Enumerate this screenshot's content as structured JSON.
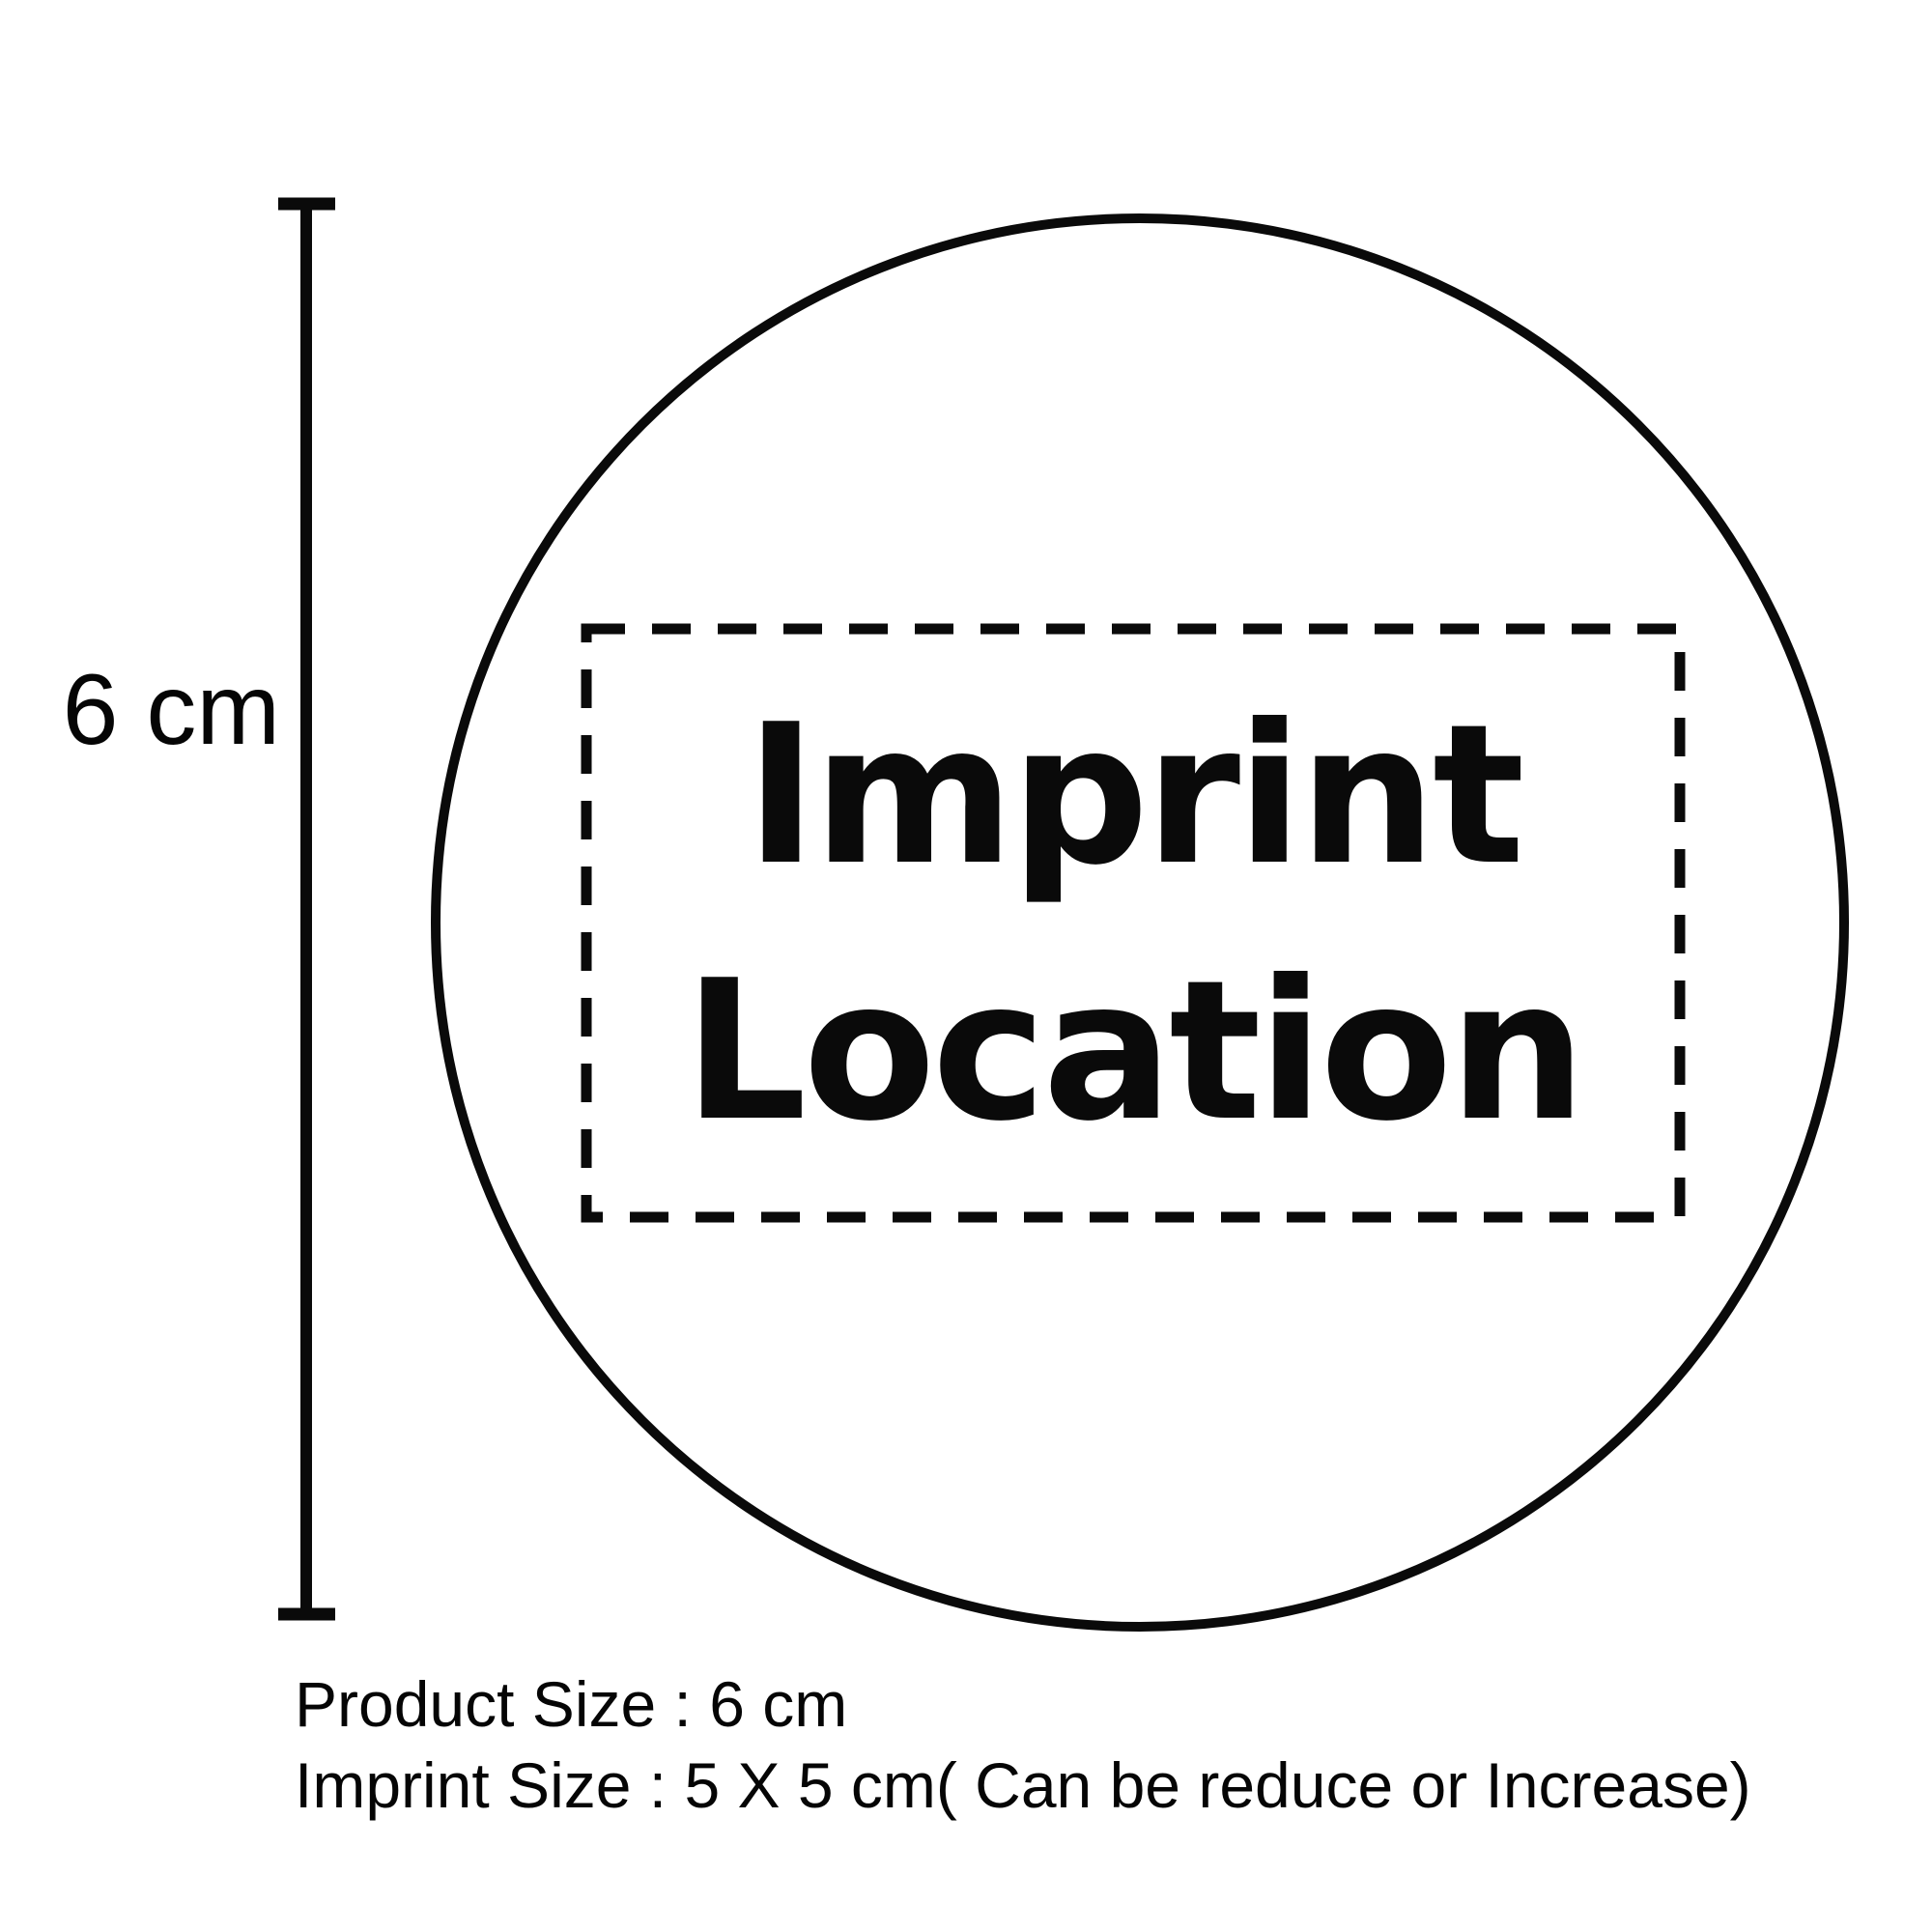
{
  "page": {
    "background_color": "#ffffff",
    "ink_color": "#0a0a0a"
  },
  "diagram": {
    "product_shape": "circle",
    "imprint_area": {
      "line1": "Imprint",
      "line2": "Location"
    },
    "dimension": {
      "label": "6 cm"
    },
    "captions": {
      "product_size": "Product Size : 6 cm",
      "imprint_size": "Imprint Size : 5 X 5 cm( Can be reduce or Increase)"
    }
  }
}
